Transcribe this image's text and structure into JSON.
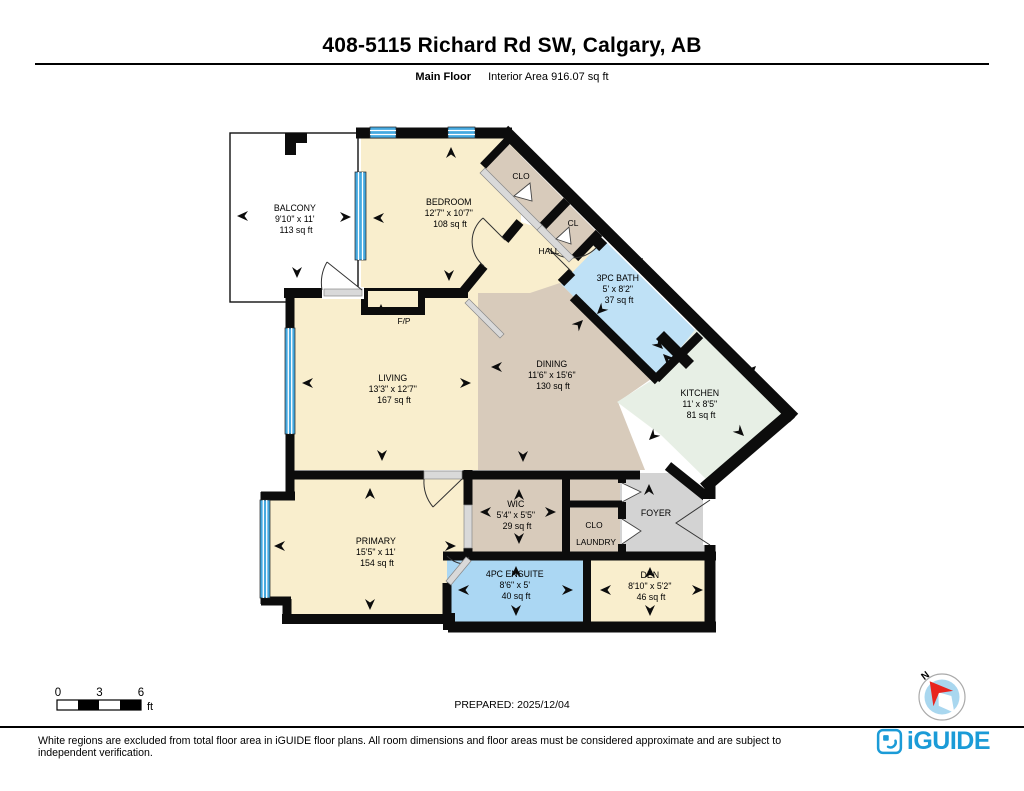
{
  "header": {
    "title": "408-5115 Richard Rd SW, Calgary, AB",
    "floor_label": "Main Floor",
    "interior_area_label": "Interior Area 916.07 sq ft"
  },
  "rooms": {
    "balcony": {
      "name": "BALCONY",
      "dims": "9'10\" x 11'",
      "area": "113 sq ft"
    },
    "bedroom": {
      "name": "BEDROOM",
      "dims": "12'7\" x 10'7\"",
      "area": "108 sq ft"
    },
    "clo_top": {
      "name": "CLO"
    },
    "cl": {
      "name": "CL"
    },
    "hall": {
      "name": "HALL"
    },
    "bath": {
      "name": "3PC BATH",
      "dims": "5' x 8'2\"",
      "area": "37 sq ft"
    },
    "kitchen": {
      "name": "KITCHEN",
      "dims": "11' x 8'5\"",
      "area": "81 sq ft"
    },
    "dining": {
      "name": "DINING",
      "dims": "11'6\" x 15'6\"",
      "area": "130 sq ft"
    },
    "living": {
      "name": "LIVING",
      "dims": "13'3\" x 12'7\"",
      "area": "167 sq ft"
    },
    "fp": {
      "name": "F/P"
    },
    "primary": {
      "name": "PRIMARY",
      "dims": "15'5\" x 11'",
      "area": "154 sq ft"
    },
    "wic": {
      "name": "WIC",
      "dims": "5'4\" x 5'5\"",
      "area": "29 sq ft"
    },
    "clo_lower": {
      "name": "CLO"
    },
    "laundry": {
      "name": "LAUNDRY"
    },
    "foyer": {
      "name": "FOYER"
    },
    "ensuite": {
      "name": "4PC ENSUITE",
      "dims": "8'6\" x 5'",
      "area": "40 sq ft"
    },
    "den": {
      "name": "DEN",
      "dims": "8'10\" x 5'2\"",
      "area": "46 sq ft"
    }
  },
  "scale_bar": {
    "labels": [
      "0",
      "3",
      "6"
    ],
    "unit": "ft"
  },
  "prepared": "PREPARED: 2025/12/04",
  "compass": {
    "north_label": "N"
  },
  "footer": {
    "disclaimer": "White regions are excluded from total floor area in iGUIDE floor plans. All room dimensions and floor areas must be considered approximate and are subject to independent verification.",
    "brand": "iGUIDE"
  },
  "colors": {
    "wall": "#0c0c0c",
    "cream": "#f9eecd",
    "tan": "#d8cbbb",
    "bath_blue": "#bfe1f6",
    "ensuite_blue": "#abd7f3",
    "kitchen_green": "#e7efe5",
    "foyer_gray": "#d3d3d3",
    "window_blue": "#45a9e0",
    "brand_blue": "#1b9bd7",
    "compass_red": "#e8251f"
  }
}
